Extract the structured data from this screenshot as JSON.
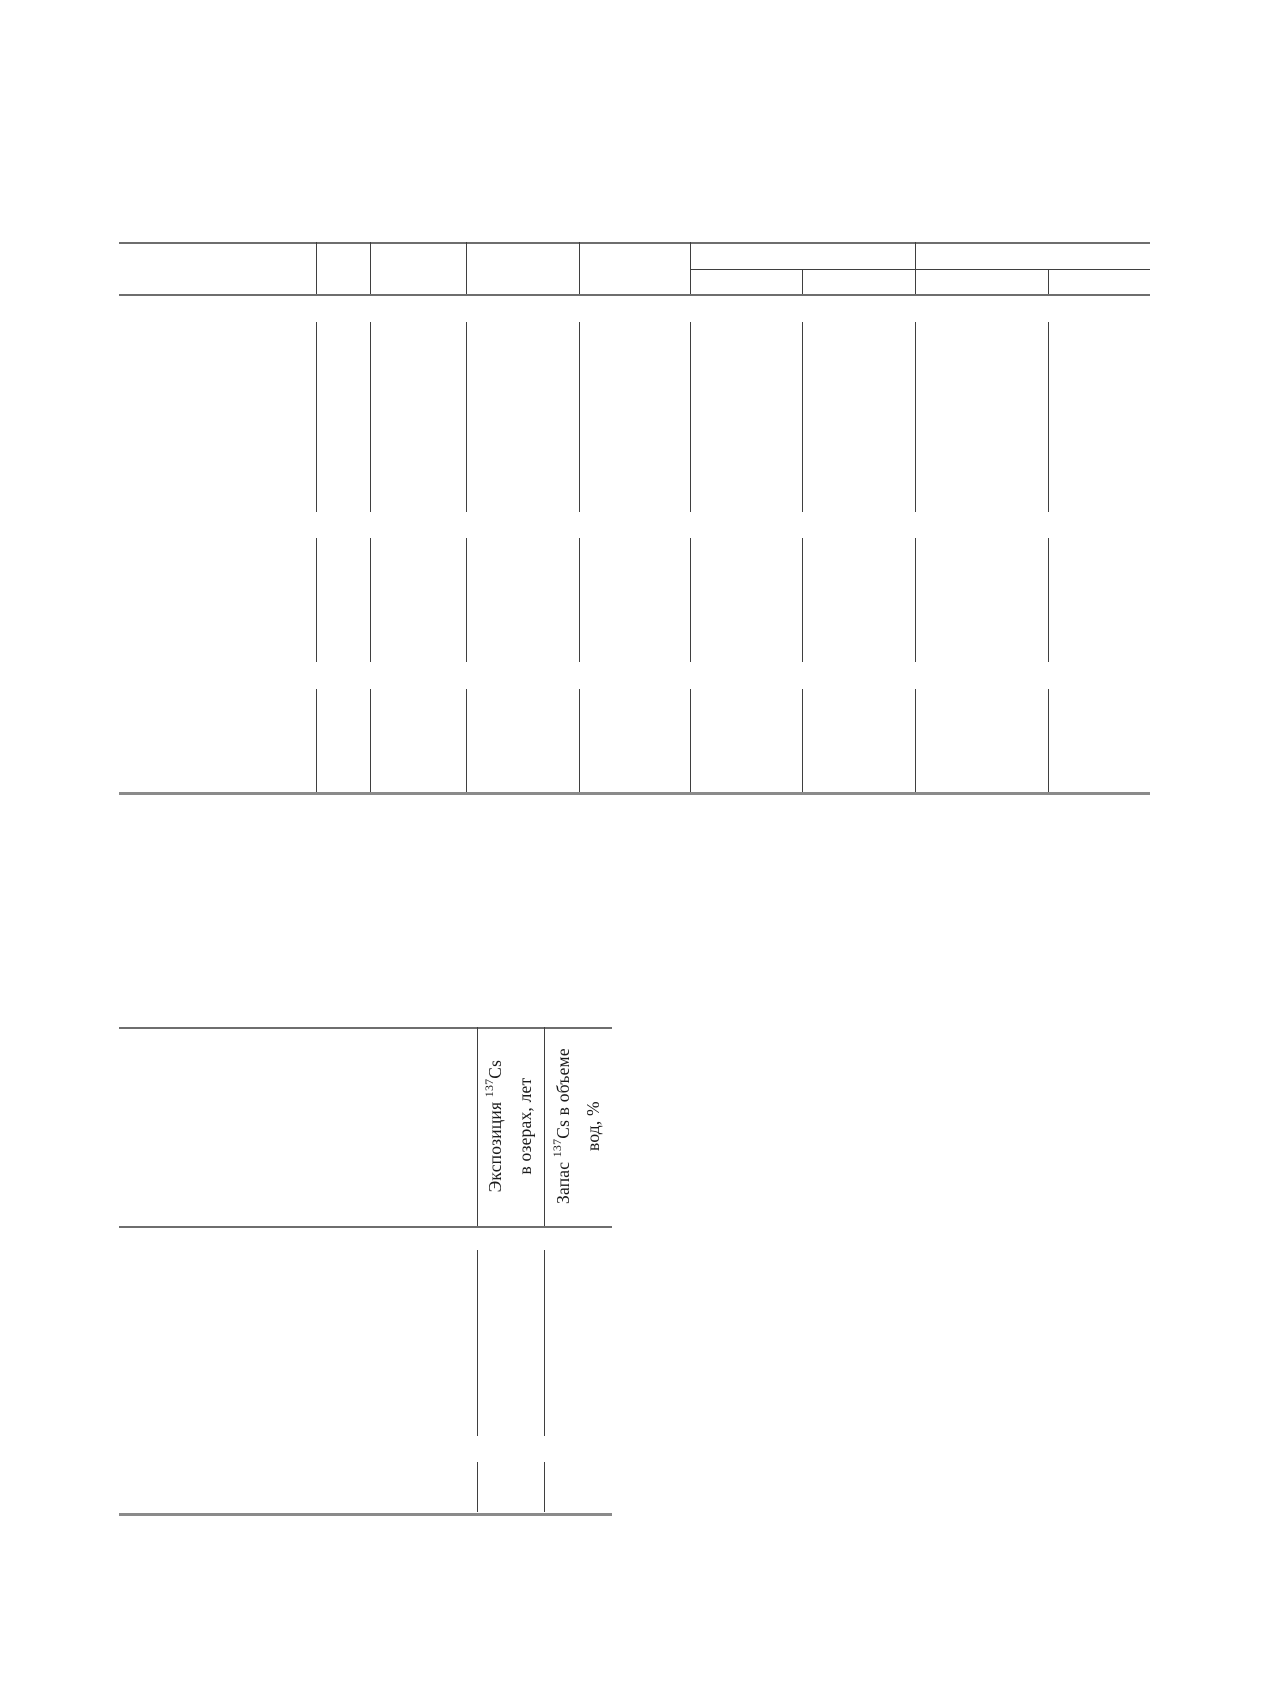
{
  "page": {
    "width": 1270,
    "height": 1683,
    "background": "#ffffff"
  },
  "colors": {
    "rule_heavy": "#6e6e6e",
    "rule_bottom": "#8a8a8a",
    "rule_dark": "#3f3f3f",
    "text": "#1b1b1b"
  },
  "upper_table": {
    "left": 119,
    "right": 1150,
    "top": 242,
    "group_subline_y": 269,
    "group_subline_x_start": 690,
    "header_bottom": 294,
    "bottom": 792,
    "header_verticals_full": [
      316,
      370,
      466,
      579,
      690,
      915
    ],
    "header_verticals_sub": [
      802,
      1048
    ],
    "body_verticals": [
      316,
      370,
      466,
      579,
      690,
      802,
      915,
      1048
    ],
    "row_bands": [
      {
        "y1": 322,
        "y2": 512
      },
      {
        "y1": 538,
        "y2": 662
      },
      {
        "y1": 689,
        "y2": 792
      }
    ]
  },
  "lower_table": {
    "left": 119,
    "right": 612,
    "top": 1027,
    "header_bottom": 1226,
    "bottom": 1513,
    "verticals": [
      477,
      544
    ],
    "row_bands": [
      {
        "y1": 1250,
        "y2": 1436
      },
      {
        "y1": 1462,
        "y2": 1512
      }
    ],
    "headers": [
      {
        "line1_pre": "Экспозиция ",
        "sup": "137",
        "line1_post": "Cs",
        "line2": "в озерах, лет"
      },
      {
        "line1_pre": "Запас ",
        "sup": "137",
        "line1_post": "Cs в объеме",
        "line2": "вод, %"
      }
    ]
  }
}
